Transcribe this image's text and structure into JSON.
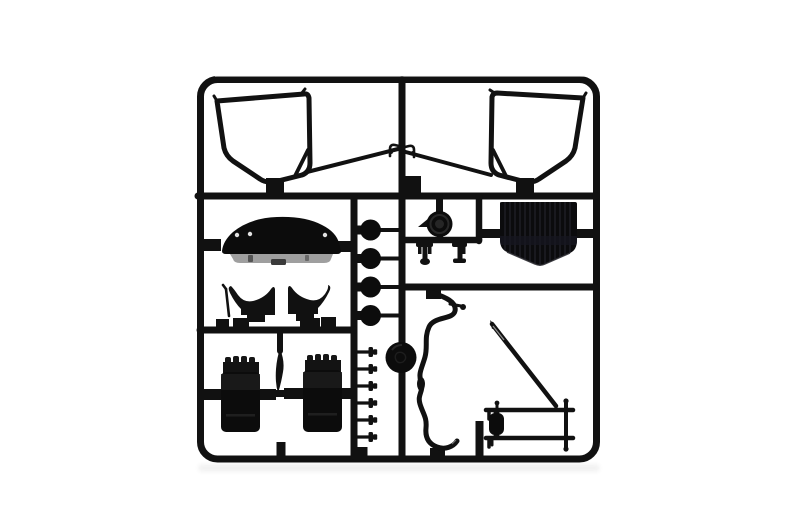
{
  "image": {
    "kind": "product-photo",
    "subject": "black injection-molded plastic model kit sprue (parts tree) on a plain white background",
    "visible_text": "none"
  },
  "colors": {
    "background": "#ffffff",
    "plastic": "#111111",
    "plastic_dark": "#0c0c0c",
    "plastic_mid": "#1c1c1c",
    "rib": "#1d1d24",
    "lip_gray": "#9f9f9f",
    "glint": "#8a8a8a",
    "dot": "#e2e2e2"
  },
  "sprue": {
    "frame": "rounded rectangle runner frame with internal cross-runners",
    "sections": {
      "top": [
        "windscreen-frame-left",
        "thin-pillar-rod-left",
        "clip-pair",
        "thin-pillar-rod-right",
        "windscreen-frame-right"
      ],
      "middle_left": [
        "dashboard",
        "seat-left",
        "seat-right",
        "gear-lever",
        "small-disc-column-x4"
      ],
      "middle_right": [
        "steering-boss",
        "clamp-parts-x2",
        "grille-panel"
      ],
      "bottom_left": [
        "engine-block-left",
        "blade-part",
        "engine-block-right",
        "pin-column-x6",
        "large-sprue-disc"
      ],
      "bottom_right": [
        "exhaust-pipe-wavy-rod",
        "antenna-rod",
        "axle-assembly"
      ]
    }
  }
}
